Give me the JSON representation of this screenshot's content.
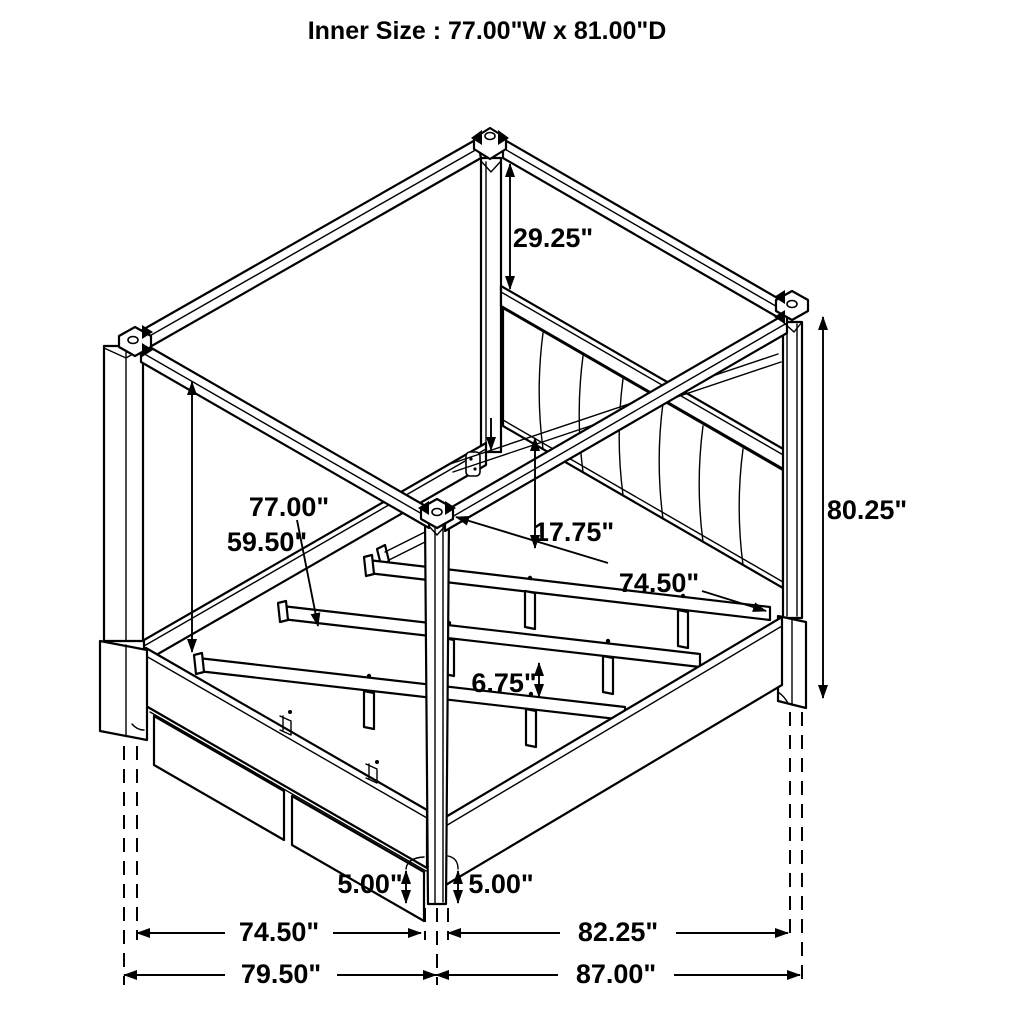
{
  "title": "Inner Size : 77.00\"W x 81.00\"D",
  "diagram": {
    "type": "furniture-dimension-drawing",
    "subject": "canopy-storage-bed",
    "colors": {
      "line": "#000000",
      "background": "#ffffff"
    },
    "dimensions": {
      "canopy_to_headboard": "29.25\"",
      "canopy_rail_to_base": "59.50\"",
      "inner_width": "77.00\"",
      "headboard_drop": "17.75\"",
      "rail_inner_span": "74.50\"",
      "slat_leg_height": "6.75\"",
      "overall_height": "80.25\"",
      "base_height_left": "5.00\"",
      "base_height_right": "5.00\"",
      "footprint_width_inner": "74.50\"",
      "footprint_width_overall": "79.50\"",
      "footprint_depth_inner": "82.25\"",
      "footprint_depth_overall": "87.00\""
    }
  }
}
